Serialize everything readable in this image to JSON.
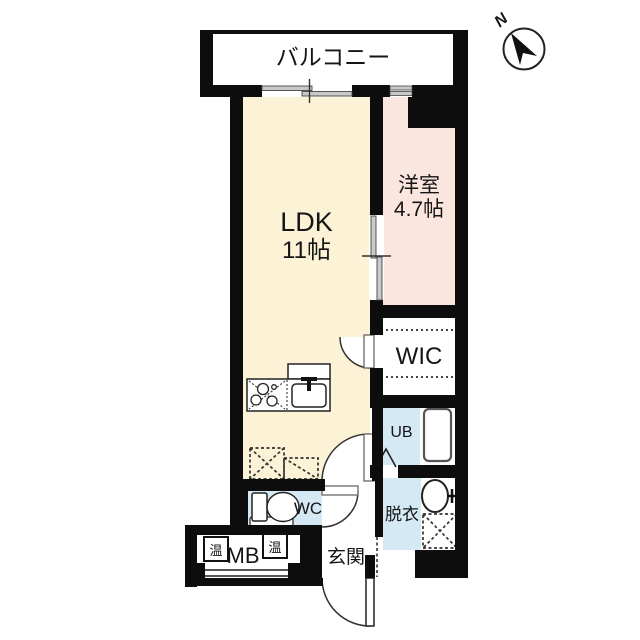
{
  "compass": {
    "north_label": "N"
  },
  "balcony": {
    "label": "バルコニー"
  },
  "ldk": {
    "label": "LDK",
    "size": "11帖"
  },
  "western_room": {
    "label": "洋室",
    "size": "4.7帖"
  },
  "wic": {
    "label": "WIC"
  },
  "unit_bath": {
    "label": "UB"
  },
  "toilet": {
    "label": "WC"
  },
  "dressing_room": {
    "label": "脱衣"
  },
  "entrance": {
    "label": "玄関"
  },
  "meter_box": {
    "label": "MB"
  },
  "water_heaters": {
    "left_label": "温",
    "right_label": "温"
  },
  "colors": {
    "ldk_floor": "#fcf2d6",
    "western_room_floor": "#fbe5df",
    "wet_area_floor": "#d5e9f4",
    "wall": "#0d0d0d",
    "door_panel_gray": "#c9c9c9"
  }
}
